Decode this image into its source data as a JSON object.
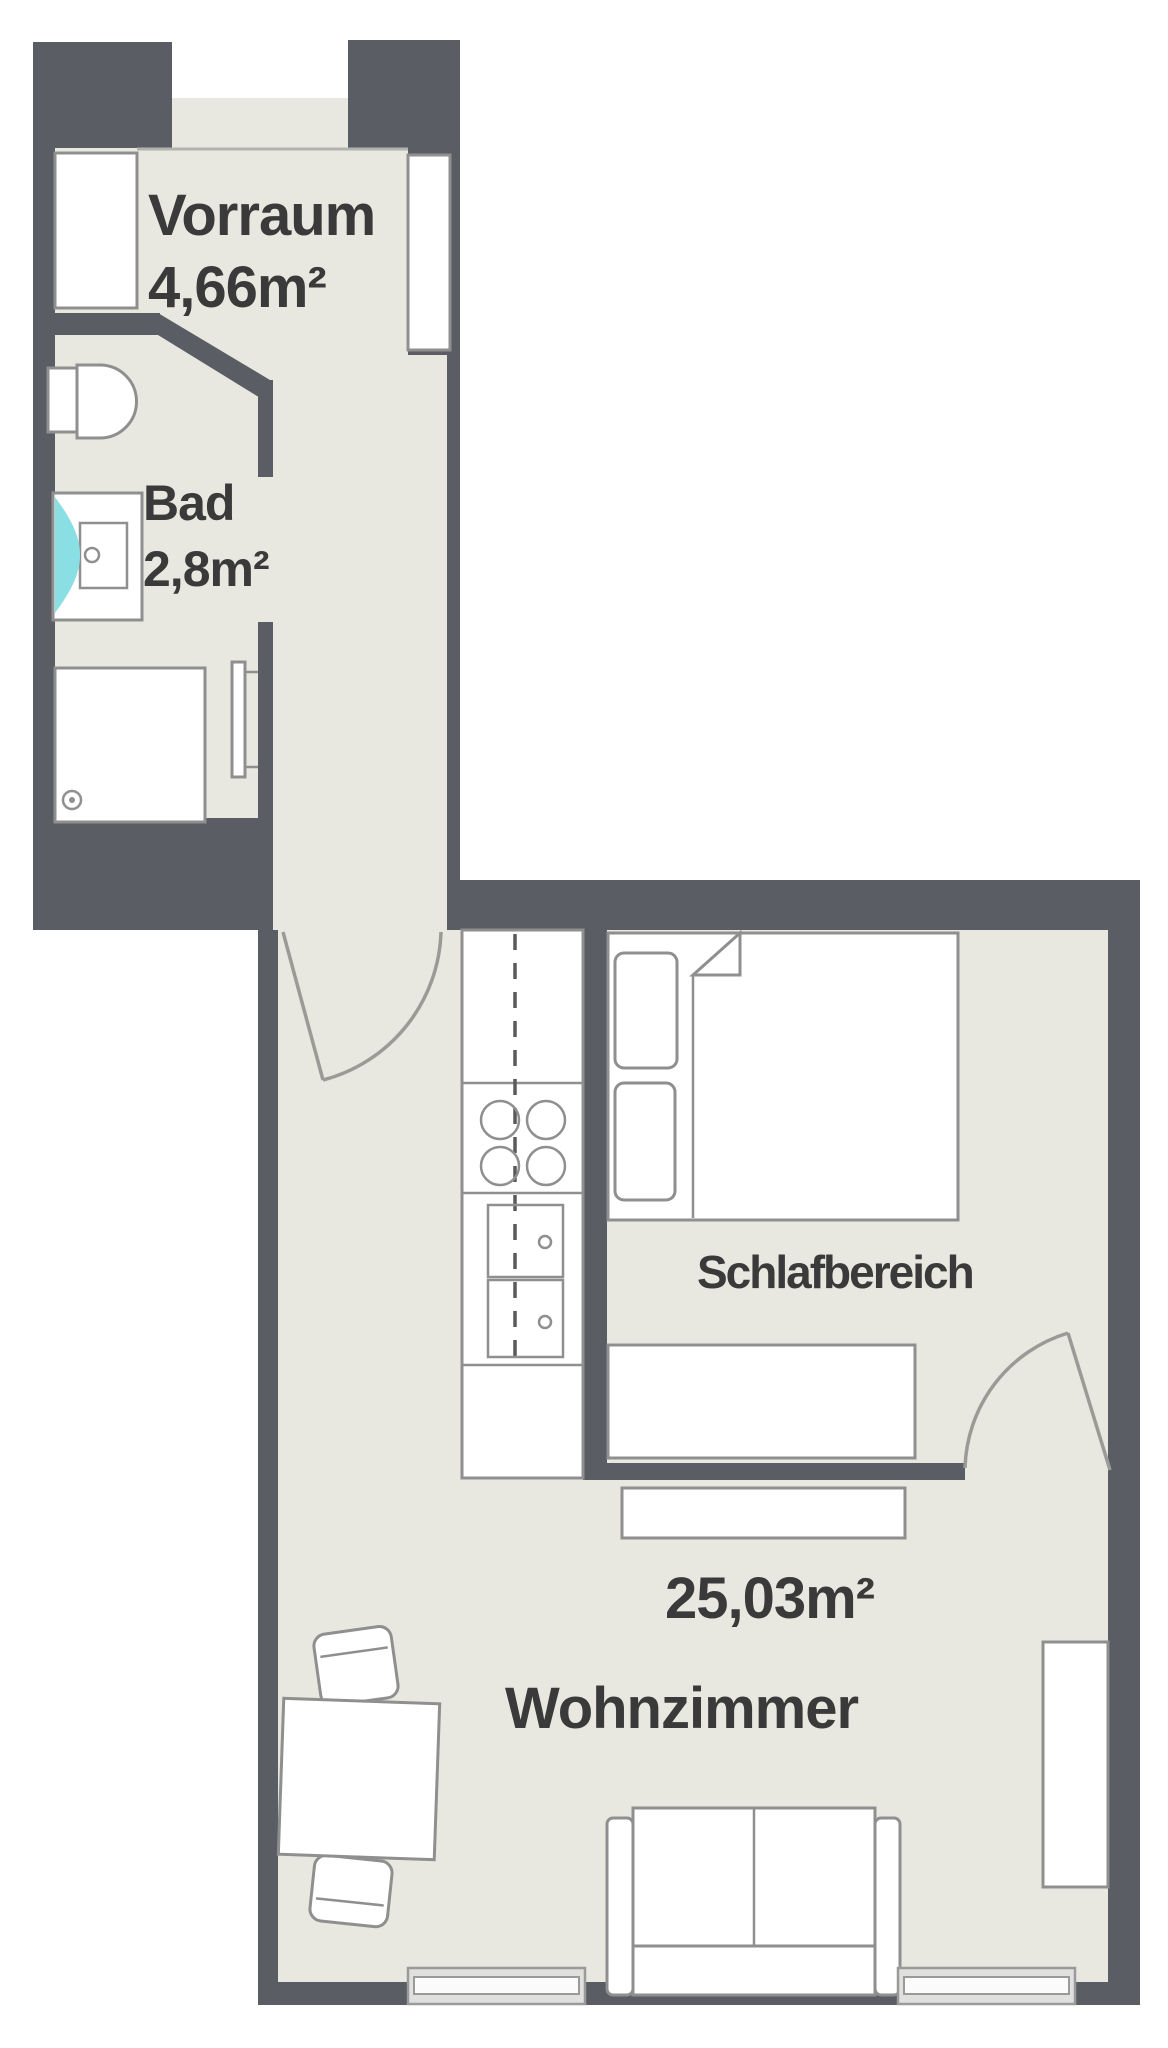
{
  "title": "Apartment floor plan",
  "rooms": {
    "vorraum": {
      "name": "Vorraum",
      "area": "4,66m²"
    },
    "bad": {
      "name": "Bad",
      "area": "2,8m²"
    },
    "schlafbereich": {
      "name": "Schlafbereich"
    },
    "wohnzimmer": {
      "name": "Wohnzimmer",
      "area": "25,03m²"
    }
  },
  "fixtures": [
    "entrance-opening",
    "built-in-closet",
    "entry-door-niche",
    "toilet",
    "washbasin",
    "shower",
    "shower-accent",
    "towel-radiator",
    "corridor-door",
    "kitchen-counter",
    "cooktop",
    "kitchen-sink",
    "double-bed",
    "pillow",
    "blanket-fold",
    "foot-bench",
    "sideboard",
    "sleeping-area-door",
    "wall-shelf",
    "dining-table",
    "chair",
    "sofa",
    "window"
  ],
  "colors": {
    "wall": "#5a5d64",
    "floor": "#e9e8e0",
    "outline": "#8f8f8f",
    "text": "#3a3a3a",
    "shower_accent": "#8adfe4",
    "window": "#e0e0de"
  }
}
